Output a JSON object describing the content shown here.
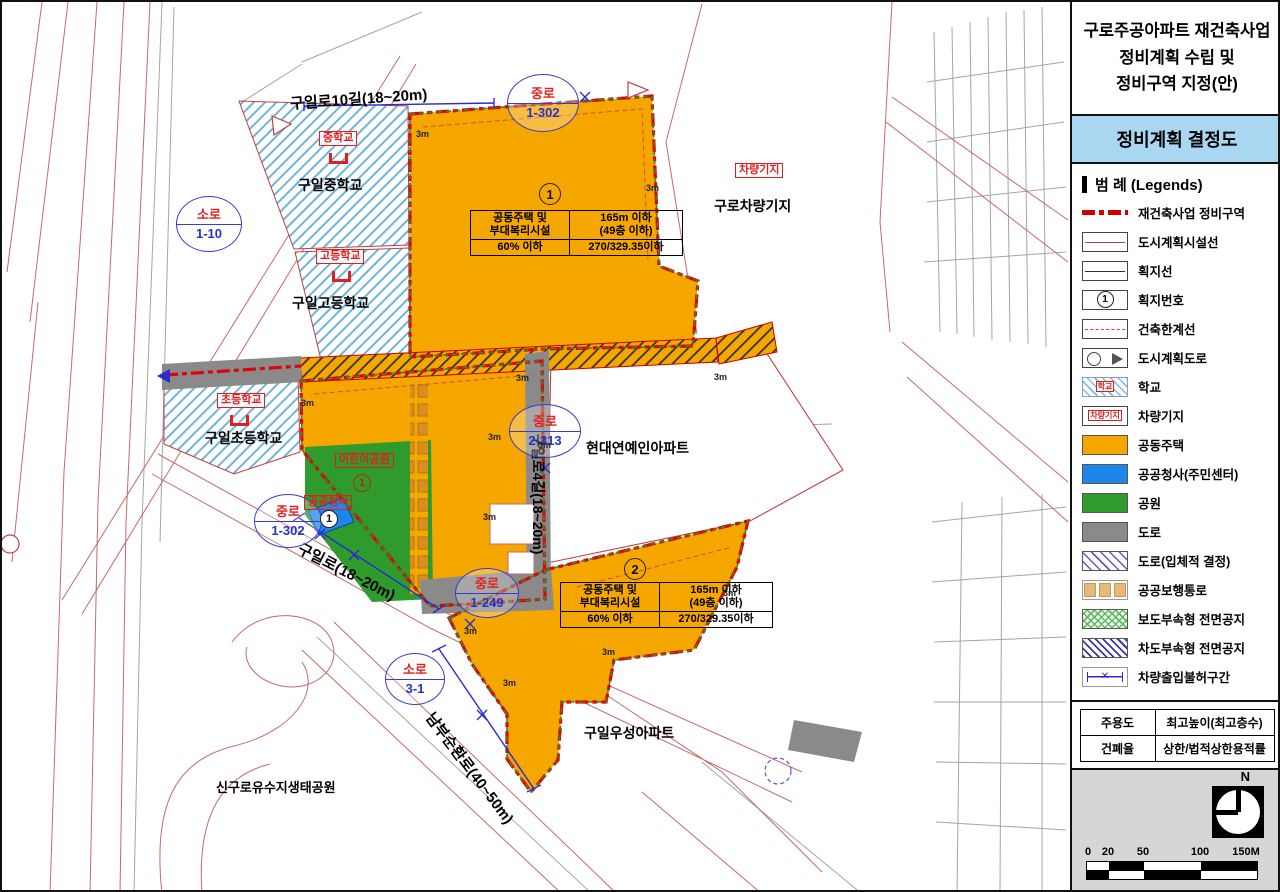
{
  "sidebar": {
    "title_lines": [
      "구로주공아파트 재건축사업",
      "정비계획 수립 및",
      "정비구역 지정(안)"
    ],
    "subtitle": "정비계획 결정도",
    "legend_header": "범  례 (Legends)",
    "legend_items": [
      {
        "label": "재건축사업 정비구역"
      },
      {
        "label": "도시계획시설선"
      },
      {
        "label": "획지선"
      },
      {
        "label": "획지번호",
        "swatch_text": "1"
      },
      {
        "label": "건축한계선"
      },
      {
        "label": "도시계획도로"
      },
      {
        "label": "학교",
        "swatch_text": "학교"
      },
      {
        "label": "차량기지",
        "swatch_text": "차량기지"
      },
      {
        "label": "공동주택"
      },
      {
        "label": "공공청사(주민센터)"
      },
      {
        "label": "공원"
      },
      {
        "label": "도로"
      },
      {
        "label": "도로(입체적 결정)"
      },
      {
        "label": "공공보행통로"
      },
      {
        "label": "보도부속형 전면공지"
      },
      {
        "label": "차도부속형 전면공지"
      },
      {
        "label": "차량출입불허구간",
        "swatch_text": "✕"
      }
    ],
    "use_table": {
      "r1c1": "주용도",
      "r1c2": "최고높이(최고층수)",
      "r2c1": "건폐율",
      "r2c2": "상한/법적상한용적률"
    },
    "north_label": "N",
    "scale_labels": [
      "0",
      "20",
      "50",
      "100",
      "150M"
    ]
  },
  "map": {
    "roads": {
      "guilro10gil": "구일로10길(18~20m)",
      "guilro": "구일로(18~20m)",
      "guilro4gil": "구일로4길(18~20m)",
      "nambusunhwanro": "남부순환로(40~50m)"
    },
    "road_circles": [
      {
        "type": "중로",
        "num": "1-302"
      },
      {
        "type": "소로",
        "num": "1-10"
      },
      {
        "type": "중로",
        "num": "1-302"
      },
      {
        "type": "중로",
        "num": "2-313"
      },
      {
        "type": "중로",
        "num": "1-249"
      },
      {
        "type": "소로",
        "num": "3-1"
      }
    ],
    "places": {
      "middle_school": "구일중학교",
      "high_school": "구일고등학교",
      "elementary_school": "구일초등학교",
      "depot": "구로차량기지",
      "hyundai_apt": "현대연예인아파트",
      "woosung_apt": "구일우성아파트",
      "eco_park": "신구로유수지생태공원"
    },
    "facility_labels": {
      "middle_school": "중학교",
      "high_school": "고등학교",
      "elementary_school": "초등학교",
      "depot": "차량기지",
      "childrens_park": "어린이공원",
      "public_office": "공공청사"
    },
    "numbers": {
      "park": "1",
      "public_office": "1"
    },
    "parcels": [
      {
        "num": "1",
        "use1": "공동주택 및",
        "use2": "부대복리시설",
        "height1": "165m 이하",
        "height2": "(49층 이하)",
        "coverage": "60% 이하",
        "far": "270/329.35이하"
      },
      {
        "num": "2",
        "use1": "공동주택 및",
        "use2": "부대복리시설",
        "height1": "165m 이하",
        "height2": "(49층 이하)",
        "coverage": "60% 이하",
        "far": "270/329.35이하"
      }
    ],
    "dim_label": "3m"
  }
}
